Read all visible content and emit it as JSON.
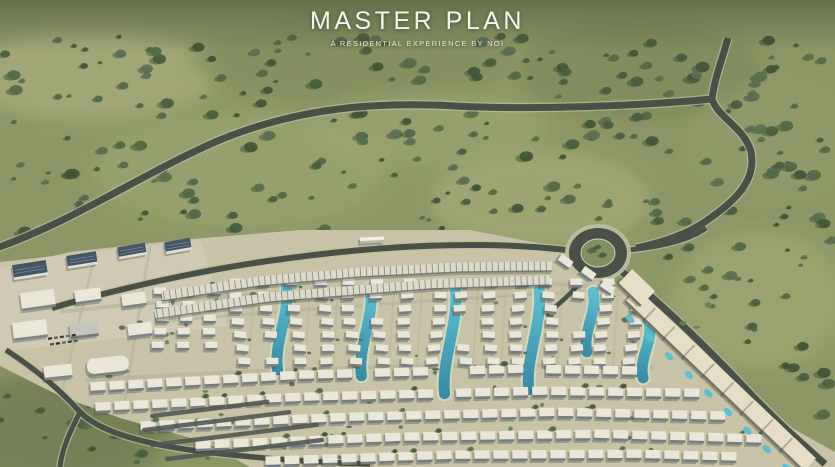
{
  "header": {
    "title": "MASTER PLAN",
    "subtitle": "A RESIDENTIAL EXPERIENCE BY NOI"
  },
  "scene": {
    "type": "aerial-render",
    "description": "Aerial 3D master plan render of a residential community: looping access highways through landscaped green fields, a planted roundabout, curved rows of townhouses and villas, turquoise swimmable lagoons between villa rows, office buildings with solar roofs, and large terraced buildings along the southeast spine road",
    "features": [
      "looping access highway",
      "landscaped roundabout",
      "curved townhouse rows",
      "villa columns with lagoons",
      "swimmable lagoons",
      "solar-roof office buildings",
      "southeast spine road with terraced slabs",
      "tree-covered green fields"
    ],
    "palette": {
      "field_base": "#87925f",
      "field_light": "#b2b285",
      "field_dark": "#66754c",
      "tree_dark": "#3f5636",
      "tree_mid": "#4a6240",
      "tree_deep": "#374c2f",
      "road_asphalt": "#42473f",
      "road_edge": "#b8bda0",
      "dev_ground": "#c6bfa4",
      "plaza": "#cfc9b6",
      "street_light": "#b3b09a",
      "roof_white": "#e9e5d8",
      "roof_cream": "#e6ddc6",
      "facade_gray": "#6f7880",
      "roof_solar": "#3c4c5c",
      "water": "#54bcd2",
      "water_deep": "#2d86a6",
      "shore": "#cfd8bb",
      "shadow": "#2f3a33",
      "island_green": "#7b8b58",
      "title_color": "#f7f7f2"
    }
  }
}
